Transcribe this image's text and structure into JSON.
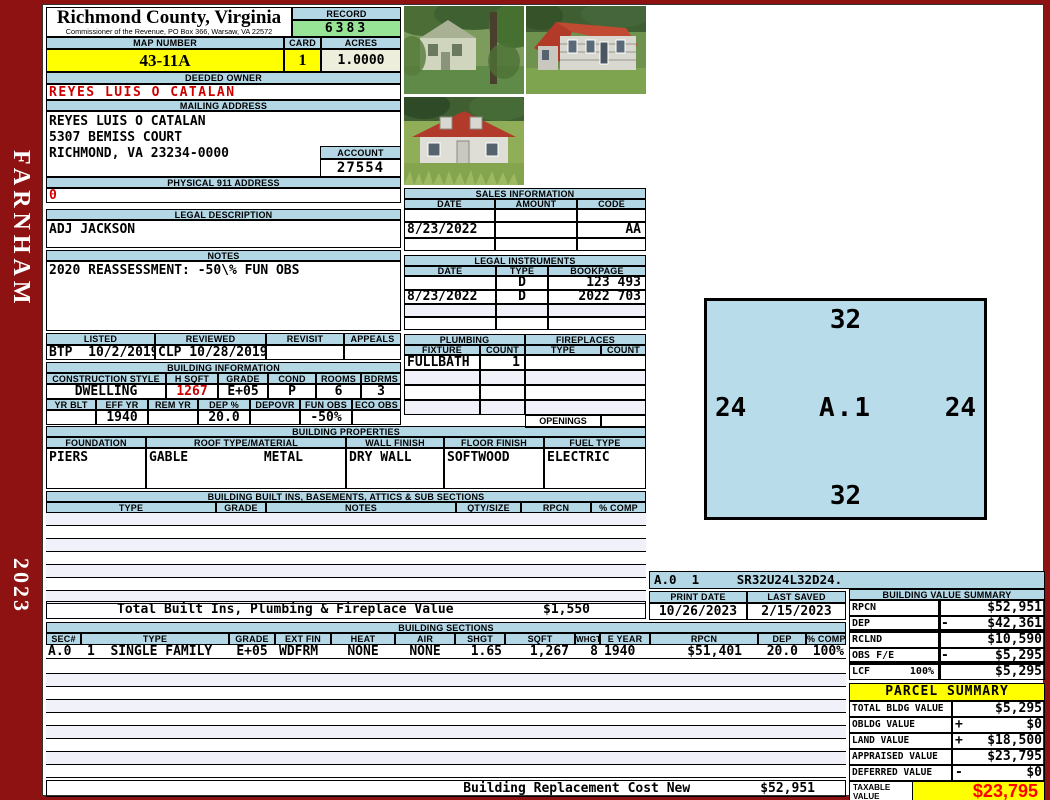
{
  "sidebar": {
    "district": "FARNHAM",
    "year": "2023"
  },
  "header": {
    "county": "Richmond County, Virginia",
    "commissioner": "Commissioner of the Revenue, PO Box 366, Warsaw, VA 22572",
    "record_label": "RECORD",
    "record": "6383",
    "map_number_label": "MAP NUMBER",
    "map_number": "43-11A",
    "card_label": "CARD",
    "card": "1",
    "acres_label": "ACRES",
    "acres": "1.0000"
  },
  "owner": {
    "deeded_owner_label": "DEEDED OWNER",
    "deeded_owner": "REYES LUIS O CATALAN",
    "mailing_address_label": "MAILING ADDRESS",
    "mailing_line1": "REYES LUIS O CATALAN",
    "mailing_line2": "5307 BEMISS COURT",
    "mailing_line3": "",
    "mailing_line4": "RICHMOND, VA 23234-0000",
    "account_label": "ACCOUNT",
    "account": "27554",
    "physical_911_label": "PHYSICAL 911 ADDRESS",
    "physical_911": "0"
  },
  "legal_description": {
    "label": "LEGAL DESCRIPTION",
    "value": "ADJ JACKSON"
  },
  "notes": {
    "label": "NOTES",
    "value": "2020 REASSESSMENT: -50\\% FUN OBS"
  },
  "visits": {
    "listed_label": "LISTED",
    "reviewed_label": "REVIEWED",
    "revisit_label": "REVISIT",
    "appeals_label": "APPEALS",
    "listed": "BTP  10/2/2019",
    "reviewed": "CLP 10/28/2019",
    "revisit": "",
    "appeals": ""
  },
  "building_information": {
    "label": "BUILDING INFORMATION",
    "construction_style_label": "CONSTRUCTION STYLE",
    "construction_style": "DWELLING",
    "hsqft_label": "H SQFT",
    "hsqft": "1267",
    "grade_label": "GRADE",
    "grade": "E+05",
    "cond_label": "COND",
    "cond": "P",
    "rooms_label": "ROOMS",
    "rooms": "6",
    "bdrms_label": "BDRMS",
    "bdrms": "3",
    "yr_blt_label": "YR BLT",
    "yr_blt": "",
    "eff_yr_label": "EFF YR",
    "eff_yr": "1940",
    "rem_yr_label": "REM YR",
    "rem_yr": "",
    "dep_label": "DEP %",
    "dep": "20.0",
    "depovr_label": "DEPOVR",
    "depovr": "",
    "fun_obs_label": "FUN OBS",
    "fun_obs": "-50%",
    "eco_obs_label": "ECO OBS",
    "eco_obs": ""
  },
  "building_properties": {
    "label": "BUILDING PROPERTIES",
    "foundation_label": "FOUNDATION",
    "foundation": "PIERS",
    "roof_label": "ROOF TYPE/MATERIAL",
    "roof_type": "GABLE",
    "roof_material": "METAL",
    "wall_finish_label": "WALL FINISH",
    "wall_finish": "DRY WALL",
    "floor_finish_label": "FLOOR FINISH",
    "floor_finish": "SOFTWOOD",
    "fuel_type_label": "FUEL TYPE",
    "fuel_type": "ELECTRIC"
  },
  "built_ins": {
    "label": "BUILDING BUILT INS, BASEMENTS, ATTICS & SUB SECTIONS",
    "headers": [
      "TYPE",
      "GRADE",
      "NOTES",
      "QTY/SIZE",
      "RPCN",
      "% COMP"
    ],
    "total_label": "Total Built Ins, Plumbing & Fireplace Value",
    "total_value": "$1,550"
  },
  "sales": {
    "label": "SALES INFORMATION",
    "headers": [
      "DATE",
      "AMOUNT",
      "CODE"
    ],
    "rows": [
      [
        "",
        "",
        ""
      ],
      [
        "8/23/2022",
        "",
        "AA"
      ],
      [
        "",
        "",
        ""
      ]
    ]
  },
  "legal_instruments": {
    "label": "LEGAL INSTRUMENTS",
    "headers": [
      "DATE",
      "TYPE",
      "BOOKPAGE"
    ],
    "rows": [
      [
        "",
        "D",
        "123 493"
      ],
      [
        "8/23/2022",
        "D",
        "2022 703"
      ],
      [
        "",
        "",
        ""
      ],
      [
        "",
        "",
        ""
      ]
    ]
  },
  "plumbing": {
    "label": "PLUMBING",
    "fixture_label": "FIXTURE",
    "count_label": "COUNT",
    "rows": [
      [
        "FULLBATH",
        "1"
      ],
      [
        "",
        ""
      ],
      [
        "",
        ""
      ],
      [
        "",
        ""
      ]
    ]
  },
  "fireplaces": {
    "label": "FIREPLACES",
    "type_label": "TYPE",
    "count_label": "COUNT",
    "rows": [
      [
        "",
        ""
      ],
      [
        "",
        ""
      ],
      [
        "",
        ""
      ],
      [
        "",
        ""
      ]
    ],
    "openings_label": "OPENINGS",
    "openings": ""
  },
  "photos": {
    "photo1": "house-in-trees-photo",
    "photo2": "house-side-view-photo",
    "photo3": "house-front-view-photo"
  },
  "sketch": {
    "code_line": "A.0  1     SR32U24L32D24.",
    "top": "32",
    "left": "24",
    "label": "A.1",
    "right": "24",
    "bottom": "32"
  },
  "print_info": {
    "print_date_label": "PRINT DATE",
    "print_date": "10/26/2023",
    "last_saved_label": "LAST SAVED",
    "last_saved": "2/15/2023"
  },
  "building_value_summary": {
    "label": "BUILDING VALUE SUMMARY",
    "rows": [
      {
        "label": "RPCN",
        "op": "",
        "value": "$52,951"
      },
      {
        "label": "DEP",
        "op": "-",
        "value": "$42,361"
      },
      {
        "label": "RCLND",
        "op": "",
        "value": "$10,590"
      },
      {
        "label": "OBS F/E",
        "op": "-",
        "value": "$5,295"
      },
      {
        "label": "LCF",
        "sub": "100%",
        "op": "",
        "value": "$5,295"
      }
    ]
  },
  "building_sections": {
    "label": "BUILDING SECTIONS",
    "headers": [
      "SEC#",
      "TYPE",
      "GRADE",
      "EXT FIN",
      "HEAT",
      "AIR",
      "SHGT",
      "SQFT",
      "WHGT",
      "E YEAR",
      "RPCN",
      "DEP",
      "% COMP"
    ],
    "row": [
      "A.0",
      "1  SINGLE FAMILY",
      "E+05",
      "WDFRM",
      "NONE",
      "NONE",
      "1.65",
      "1,267",
      "8",
      "1940",
      "$51,401",
      "20.0",
      "100%"
    ]
  },
  "replacement_cost": {
    "label": "Building Replacement Cost New",
    "value": "$52,951"
  },
  "parcel_summary": {
    "label": "PARCEL SUMMARY",
    "rows": [
      {
        "label": "TOTAL BLDG VALUE",
        "op": "",
        "value": "$5,295"
      },
      {
        "label": "OBLDG VALUE",
        "op": "+",
        "value": "$0"
      },
      {
        "label": "LAND VALUE",
        "op": "+",
        "value": "$18,500"
      },
      {
        "label": "APPRAISED VALUE",
        "op": "",
        "value": "$23,795"
      },
      {
        "label": "DEFERRED VALUE",
        "op": "-",
        "value": "$0"
      }
    ],
    "taxable_label": "TAXABLE VALUE",
    "taxable_value": "$23,795"
  },
  "colors": {
    "accent_maroon": "#8e1212",
    "header_blue": "#b4d7e6",
    "record_green": "#97e497",
    "highlight_yellow": "#ffff00",
    "acres_cream": "#eeeedd",
    "owner_red": "#cc0000",
    "taxable_red": "#ff0000",
    "sketch_blue": "#b9dcea"
  }
}
